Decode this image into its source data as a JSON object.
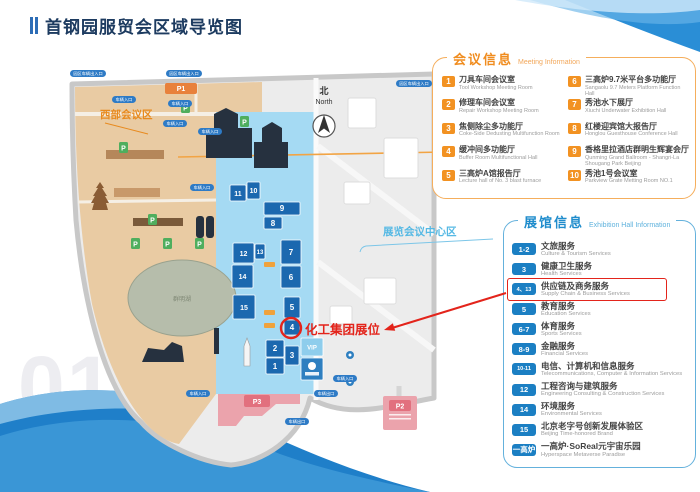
{
  "page": {
    "title": "首钢园服贸会区域导览图",
    "page_number": "01"
  },
  "colors": {
    "accent_orange": "#f08c1e",
    "accent_blue": "#1f8ccc",
    "highlight_red": "#e3241b",
    "title_navy": "#1d3b60",
    "wave_blue": "#1f7fc9"
  },
  "map": {
    "compass": {
      "zh": "北",
      "en": "North"
    },
    "region_labels": {
      "west": "西部会议区",
      "center": "展览会议中心区"
    },
    "annotation": {
      "text": "化工集团展位"
    },
    "lake_label": "群明湖",
    "parking": {
      "p1": "P1",
      "p2": "P2",
      "p3": "P3",
      "p_badge": "P"
    },
    "gate_labels": {
      "park_gate": "园区车辆出入口",
      "vehicle_entrance": "车辆入口",
      "vehicle_exit": "车辆出口"
    },
    "halls": [
      "1",
      "2",
      "3",
      "4",
      "5",
      "6",
      "7",
      "8",
      "9",
      "10",
      "11",
      "12",
      "13",
      "14",
      "15",
      "VIP"
    ]
  },
  "meeting_panel": {
    "title_zh": "会议信息",
    "title_en": "Meeting Information",
    "items": [
      {
        "num": "1",
        "zh": "刀具车间会议室",
        "en": "Tool Workshop Meeting Room"
      },
      {
        "num": "2",
        "zh": "修理车间会议室",
        "en": "Repair Workshop Meeting Room"
      },
      {
        "num": "3",
        "zh": "焦侧除尘多功能厅",
        "en": "Coke-Side Dedusting Multifunction Room"
      },
      {
        "num": "4",
        "zh": "缓冲间多功能厅",
        "en": "Buffer Room Multifunctional Hall"
      },
      {
        "num": "5",
        "zh": "三高炉A馆报告厅",
        "en": "Lecture hall of No. 3 blast furnace"
      },
      {
        "num": "6",
        "zh": "三高炉9.7米平台多功能厅",
        "en": "Sangaolu 9.7 Meters Platform Function Hall"
      },
      {
        "num": "7",
        "zh": "秀池水下展厅",
        "en": "Xiuchi Underwater Exhibition Hall"
      },
      {
        "num": "8",
        "zh": "红楼迎宾馆大报告厅",
        "en": "Honglou Guesthouse Conference Hall"
      },
      {
        "num": "9",
        "zh": "香格里拉酒店群明生辉宴会厅",
        "en": "Qunming Grand Ballroom - Shangri-La Shougang Park Beijing"
      },
      {
        "num": "10",
        "zh": "秀池1号会议室",
        "en": "Parkview Grate Metting Room NO.1"
      }
    ]
  },
  "exhibition_panel": {
    "title_zh": "展馆信息",
    "title_en": "Exhibition Hall Information",
    "items": [
      {
        "num": "1-2",
        "zh": "文旅服务",
        "en": "Culture & Tourism Services",
        "highlight": false
      },
      {
        "num": "3",
        "zh": "健康卫生服务",
        "en": "Health Services",
        "highlight": false
      },
      {
        "num": "4、13",
        "zh": "供应链及商务服务",
        "en": "Supply Chain & Business Services",
        "highlight": true
      },
      {
        "num": "5",
        "zh": "教育服务",
        "en": "Education Services",
        "highlight": false
      },
      {
        "num": "6-7",
        "zh": "体育服务",
        "en": "Sports Services",
        "highlight": false
      },
      {
        "num": "8-9",
        "zh": "金融服务",
        "en": "Financial Services",
        "highlight": false
      },
      {
        "num": "10-11",
        "zh": "电信、计算机和信息服务",
        "en": "Telecommunications, Computer & Information Services",
        "highlight": false
      },
      {
        "num": "12",
        "zh": "工程咨询与建筑服务",
        "en": "Engineering Consulting & Construction Services",
        "highlight": false
      },
      {
        "num": "14",
        "zh": "环境服务",
        "en": "Environmental Services",
        "highlight": false
      },
      {
        "num": "15",
        "zh": "北京老字号创新发展体验区",
        "en": "Beijing Time-honored Brand",
        "highlight": false
      },
      {
        "num": "一高炉",
        "zh": "一高炉·SoReal元宇宙乐园",
        "en": "Hyperspace Metaverse Paradise",
        "highlight": false
      }
    ]
  }
}
